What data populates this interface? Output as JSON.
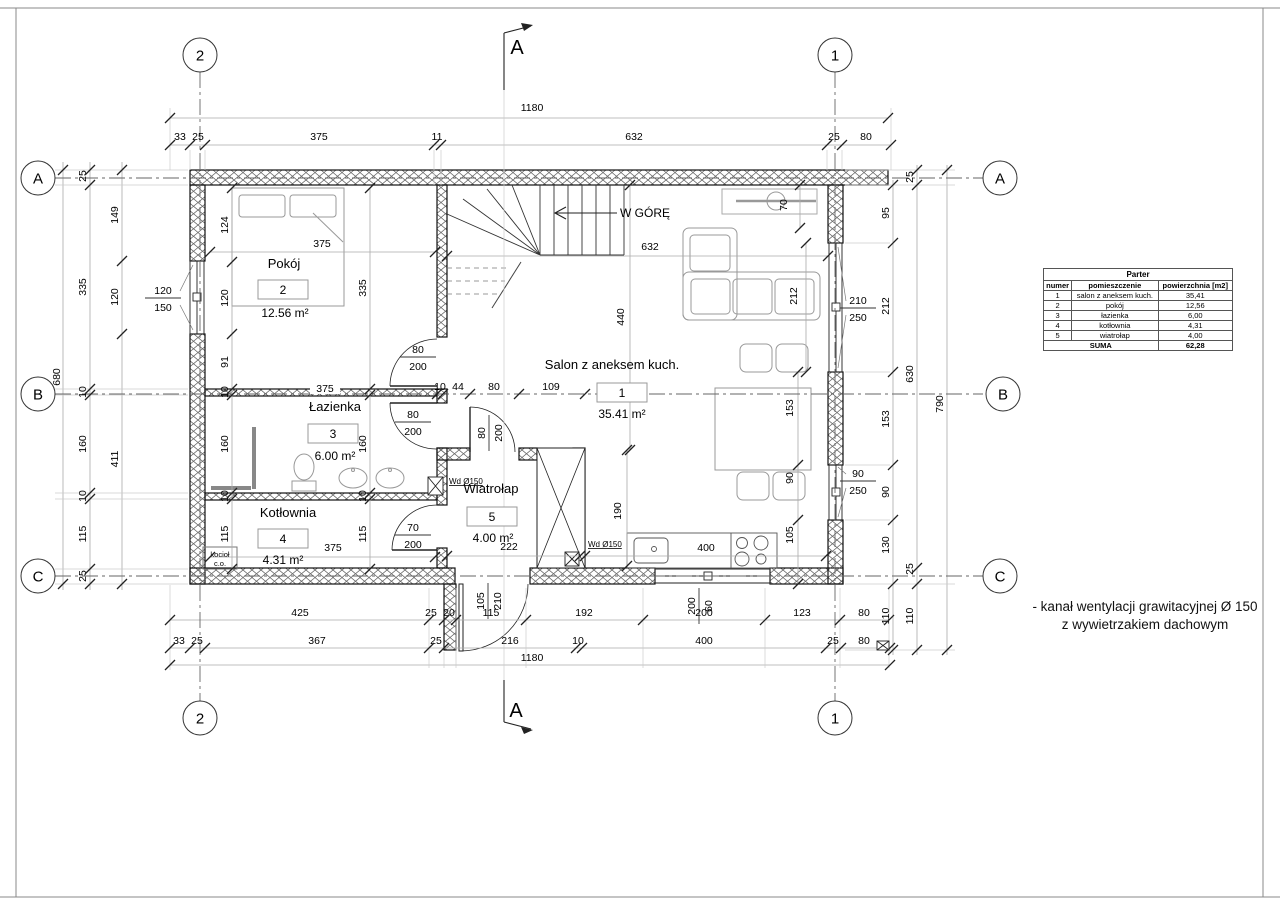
{
  "drawing": {
    "floor_table": {
      "title": "Parter",
      "columns": [
        "numer",
        "pomieszczenie",
        "powierzchnia [m2]"
      ],
      "rows": [
        [
          "1",
          "salon z aneksem kuch.",
          "35,41"
        ],
        [
          "2",
          "pokój",
          "12,56"
        ],
        [
          "3",
          "łazienka",
          "6,00"
        ],
        [
          "4",
          "kotłownia",
          "4,31"
        ],
        [
          "5",
          "wiatrołap",
          "4,00"
        ]
      ],
      "sum_label": "SUMA",
      "sum_value": "62,28"
    },
    "note_lines": [
      "- kanał wentylacji grawitacyjnej Ø 150",
      "z wywietrzakiem dachowym"
    ],
    "rooms": [
      {
        "number": "1",
        "name": "Salon z aneksem kuch.",
        "area": "35.41 m²",
        "nx": 612,
        "ny": 369,
        "bx": 622,
        "by": 393,
        "ax": 622,
        "ay": 418
      },
      {
        "number": "2",
        "name": "Pokój",
        "area": "12.56 m²",
        "nx": 284,
        "ny": 268,
        "bx": 283,
        "by": 290,
        "ax": 285,
        "ay": 317
      },
      {
        "number": "3",
        "name": "Łazienka",
        "area": "6.00 m²",
        "nx": 335,
        "ny": 411,
        "bx": 333,
        "by": 434,
        "ax": 335,
        "ay": 460
      },
      {
        "number": "4",
        "name": "Kotłownia",
        "area": "4.31 m²",
        "nx": 288,
        "ny": 517,
        "bx": 283,
        "by": 539,
        "ax": 283,
        "ay": 564
      },
      {
        "number": "5",
        "name": "Wiatrołap",
        "area": "4.00 m²",
        "nx": 491,
        "ny": 493,
        "bx": 492,
        "by": 517,
        "ax": 493,
        "ay": 542
      }
    ],
    "grid_bubbles": [
      {
        "l": "2",
        "x": 200,
        "y": 55
      },
      {
        "l": "1",
        "x": 835,
        "y": 55
      },
      {
        "l": "2",
        "x": 200,
        "y": 718
      },
      {
        "l": "1",
        "x": 835,
        "y": 718
      },
      {
        "l": "A",
        "x": 38,
        "y": 178
      },
      {
        "l": "B",
        "x": 38,
        "y": 394
      },
      {
        "l": "C",
        "x": 38,
        "y": 576
      },
      {
        "l": "A",
        "x": 1000,
        "y": 178
      },
      {
        "l": "B",
        "x": 1003,
        "y": 394
      },
      {
        "l": "C",
        "x": 1000,
        "y": 576
      }
    ],
    "section_marks": [
      {
        "l": "A",
        "x": 517,
        "y": 54
      },
      {
        "l": "A",
        "x": 516,
        "y": 717
      }
    ],
    "labels": [
      {
        "t": "W GÓRĘ",
        "x": 645,
        "y": 217,
        "s": 12
      },
      {
        "t": "Wd Ø150",
        "x": 449,
        "y": 484,
        "s": 8,
        "a": "start",
        "u": 1
      },
      {
        "t": "Wd Ø150",
        "x": 588,
        "y": 547,
        "s": 8,
        "a": "start",
        "u": 1
      },
      {
        "t": "kocioł",
        "x": 220,
        "y": 557,
        "s": 7.5
      },
      {
        "t": "c.o.",
        "x": 220,
        "y": 566,
        "s": 7.5
      }
    ],
    "dims": [
      {
        "t": "1180",
        "x": 532,
        "y": 111
      },
      {
        "t": "33",
        "x": 180,
        "y": 140
      },
      {
        "t": "25",
        "x": 198,
        "y": 140
      },
      {
        "t": "375",
        "x": 319,
        "y": 140
      },
      {
        "t": "11",
        "x": 437,
        "y": 140
      },
      {
        "t": "632",
        "x": 634,
        "y": 140
      },
      {
        "t": "25",
        "x": 834,
        "y": 140
      },
      {
        "t": "80",
        "x": 866,
        "y": 140
      },
      {
        "t": "425",
        "x": 300,
        "y": 616
      },
      {
        "t": "25",
        "x": 431,
        "y": 616
      },
      {
        "t": "20",
        "x": 449,
        "y": 616
      },
      {
        "t": "115",
        "x": 491,
        "y": 616
      },
      {
        "t": "192",
        "x": 584,
        "y": 616
      },
      {
        "t": "200",
        "x": 704,
        "y": 616
      },
      {
        "t": "123",
        "x": 802,
        "y": 616
      },
      {
        "t": "80",
        "x": 864,
        "y": 616
      },
      {
        "t": "33",
        "x": 179,
        "y": 644
      },
      {
        "t": "25",
        "x": 197,
        "y": 644
      },
      {
        "t": "367",
        "x": 317,
        "y": 644
      },
      {
        "t": "25",
        "x": 436,
        "y": 644
      },
      {
        "t": "216",
        "x": 510,
        "y": 644
      },
      {
        "t": "10",
        "x": 578,
        "y": 644
      },
      {
        "t": "400",
        "x": 704,
        "y": 644
      },
      {
        "t": "25",
        "x": 833,
        "y": 644
      },
      {
        "t": "80",
        "x": 864,
        "y": 644
      },
      {
        "t": "1180",
        "x": 532,
        "y": 661
      },
      {
        "t": "25",
        "x": 86,
        "y": 176,
        "r": 1
      },
      {
        "t": "335",
        "x": 86,
        "y": 287,
        "r": 1
      },
      {
        "t": "10",
        "x": 86,
        "y": 392,
        "r": 1
      },
      {
        "t": "160",
        "x": 86,
        "y": 444,
        "r": 1
      },
      {
        "t": "10",
        "x": 86,
        "y": 496,
        "r": 1
      },
      {
        "t": "115",
        "x": 86,
        "y": 534,
        "r": 1
      },
      {
        "t": "25",
        "x": 86,
        "y": 576,
        "r": 1
      },
      {
        "t": "149",
        "x": 118,
        "y": 215,
        "r": 1
      },
      {
        "t": "120",
        "x": 118,
        "y": 297,
        "r": 1
      },
      {
        "t": "411",
        "x": 118,
        "y": 459,
        "r": 1
      },
      {
        "t": "680",
        "x": 60,
        "y": 377,
        "r": 1
      },
      {
        "t": "95",
        "x": 889,
        "y": 213,
        "r": 1
      },
      {
        "t": "212",
        "x": 889,
        "y": 306,
        "r": 1
      },
      {
        "t": "153",
        "x": 889,
        "y": 419,
        "r": 1
      },
      {
        "t": "90",
        "x": 889,
        "y": 492,
        "r": 1
      },
      {
        "t": "130",
        "x": 889,
        "y": 545,
        "r": 1
      },
      {
        "t": "110",
        "x": 889,
        "y": 616,
        "r": 1
      },
      {
        "t": "25",
        "x": 913,
        "y": 177,
        "r": 1
      },
      {
        "t": "630",
        "x": 913,
        "y": 374,
        "r": 1
      },
      {
        "t": "25",
        "x": 913,
        "y": 569,
        "r": 1
      },
      {
        "t": "110",
        "x": 913,
        "y": 616,
        "r": 1
      },
      {
        "t": "790",
        "x": 943,
        "y": 404,
        "r": 1
      },
      {
        "t": "124",
        "x": 228,
        "y": 225,
        "r": 1
      },
      {
        "t": "120",
        "x": 228,
        "y": 298,
        "r": 1
      },
      {
        "t": "91",
        "x": 228,
        "y": 362,
        "r": 1
      },
      {
        "t": "10",
        "x": 228,
        "y": 392,
        "r": 1
      },
      {
        "t": "160",
        "x": 228,
        "y": 444,
        "r": 1
      },
      {
        "t": "10",
        "x": 228,
        "y": 496,
        "r": 1
      },
      {
        "t": "115",
        "x": 228,
        "y": 534,
        "r": 1
      },
      {
        "t": "335",
        "x": 366,
        "y": 288,
        "r": 1
      },
      {
        "t": "160",
        "x": 366,
        "y": 444,
        "r": 1
      },
      {
        "t": "10",
        "x": 366,
        "y": 496,
        "r": 1
      },
      {
        "t": "115",
        "x": 366,
        "y": 534,
        "r": 1
      },
      {
        "t": "375",
        "x": 322,
        "y": 247
      },
      {
        "t": "375",
        "x": 325,
        "y": 392,
        "bg": 1
      },
      {
        "t": "375",
        "x": 333,
        "y": 551
      },
      {
        "t": "10",
        "x": 440,
        "y": 390
      },
      {
        "t": "44",
        "x": 458,
        "y": 390
      },
      {
        "t": "80",
        "x": 494,
        "y": 390
      },
      {
        "t": "109",
        "x": 551,
        "y": 390
      },
      {
        "t": "632",
        "x": 650,
        "y": 250
      },
      {
        "t": "440",
        "x": 624,
        "y": 317,
        "r": 1
      },
      {
        "t": "212",
        "x": 797,
        "y": 296,
        "r": 1
      },
      {
        "t": "70",
        "x": 787,
        "y": 205,
        "r": 1
      },
      {
        "t": "190",
        "x": 621,
        "y": 511,
        "r": 1
      },
      {
        "t": "153",
        "x": 793,
        "y": 408,
        "r": 1
      },
      {
        "t": "90",
        "x": 793,
        "y": 478,
        "r": 1
      },
      {
        "t": "105",
        "x": 793,
        "y": 535,
        "r": 1
      },
      {
        "t": "400",
        "x": 706,
        "y": 551,
        "bg": 1
      },
      {
        "t": "222",
        "x": 509,
        "y": 550
      }
    ],
    "opening_markers": [
      {
        "a": "120",
        "b": "150",
        "x": 163,
        "y": 298,
        "r": 0
      },
      {
        "a": "210",
        "b": "250",
        "x": 858,
        "y": 308,
        "r": 0
      },
      {
        "a": "90",
        "b": "250",
        "x": 858,
        "y": 481,
        "r": 0
      },
      {
        "a": "80",
        "b": "200",
        "x": 418,
        "y": 357,
        "r": 0
      },
      {
        "a": "80",
        "b": "200",
        "x": 413,
        "y": 422,
        "r": 0
      },
      {
        "a": "70",
        "b": "200",
        "x": 413,
        "y": 535,
        "r": 0
      },
      {
        "a": "80",
        "b": "200",
        "x": 489,
        "y": 433,
        "r": 1
      },
      {
        "a": "105",
        "b": "210",
        "x": 488,
        "y": 601,
        "r": 1
      },
      {
        "a": "200",
        "b": "60",
        "x": 699,
        "y": 606,
        "r": 1
      }
    ],
    "colors": {
      "line": "#000000",
      "dimline": "#aaaaaa",
      "furniture": "#999999"
    }
  }
}
